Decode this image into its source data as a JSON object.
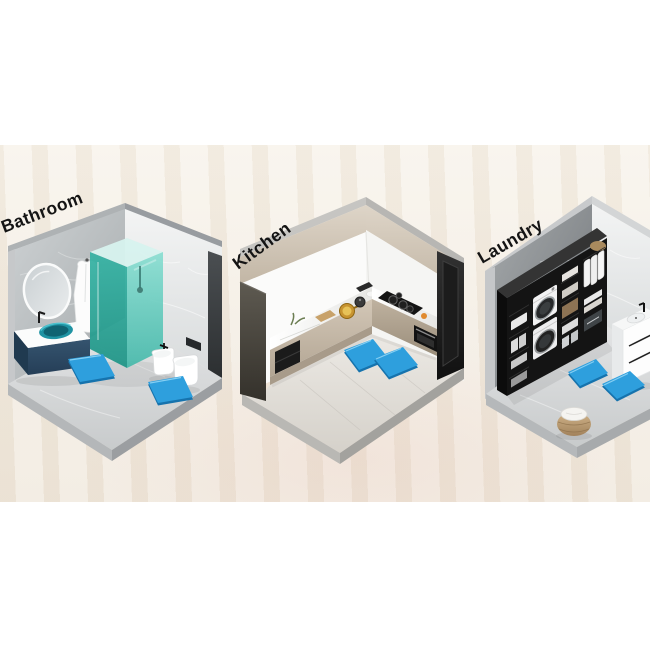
{
  "page": {
    "background": "#ffffff"
  },
  "backdrop": {
    "band_color": "#f2ebe0"
  },
  "labels": {
    "color": "#141414"
  },
  "colors": {
    "mat": "#2e9fdd",
    "mat_dark": "#1673ad",
    "mat_highlight": "#8fd4f5",
    "shower_teal": "#3ab5a6",
    "vanity_navy": "#2c4b66",
    "kitchen_beige": "#c3b7a6",
    "furniture_black": "#161616"
  },
  "rooms": [
    {
      "label": "Bathroom",
      "mats_visible": 2
    },
    {
      "label": "Kitchen",
      "mats_visible": 2
    },
    {
      "label": "Laundry",
      "mats_visible": 2
    }
  ]
}
